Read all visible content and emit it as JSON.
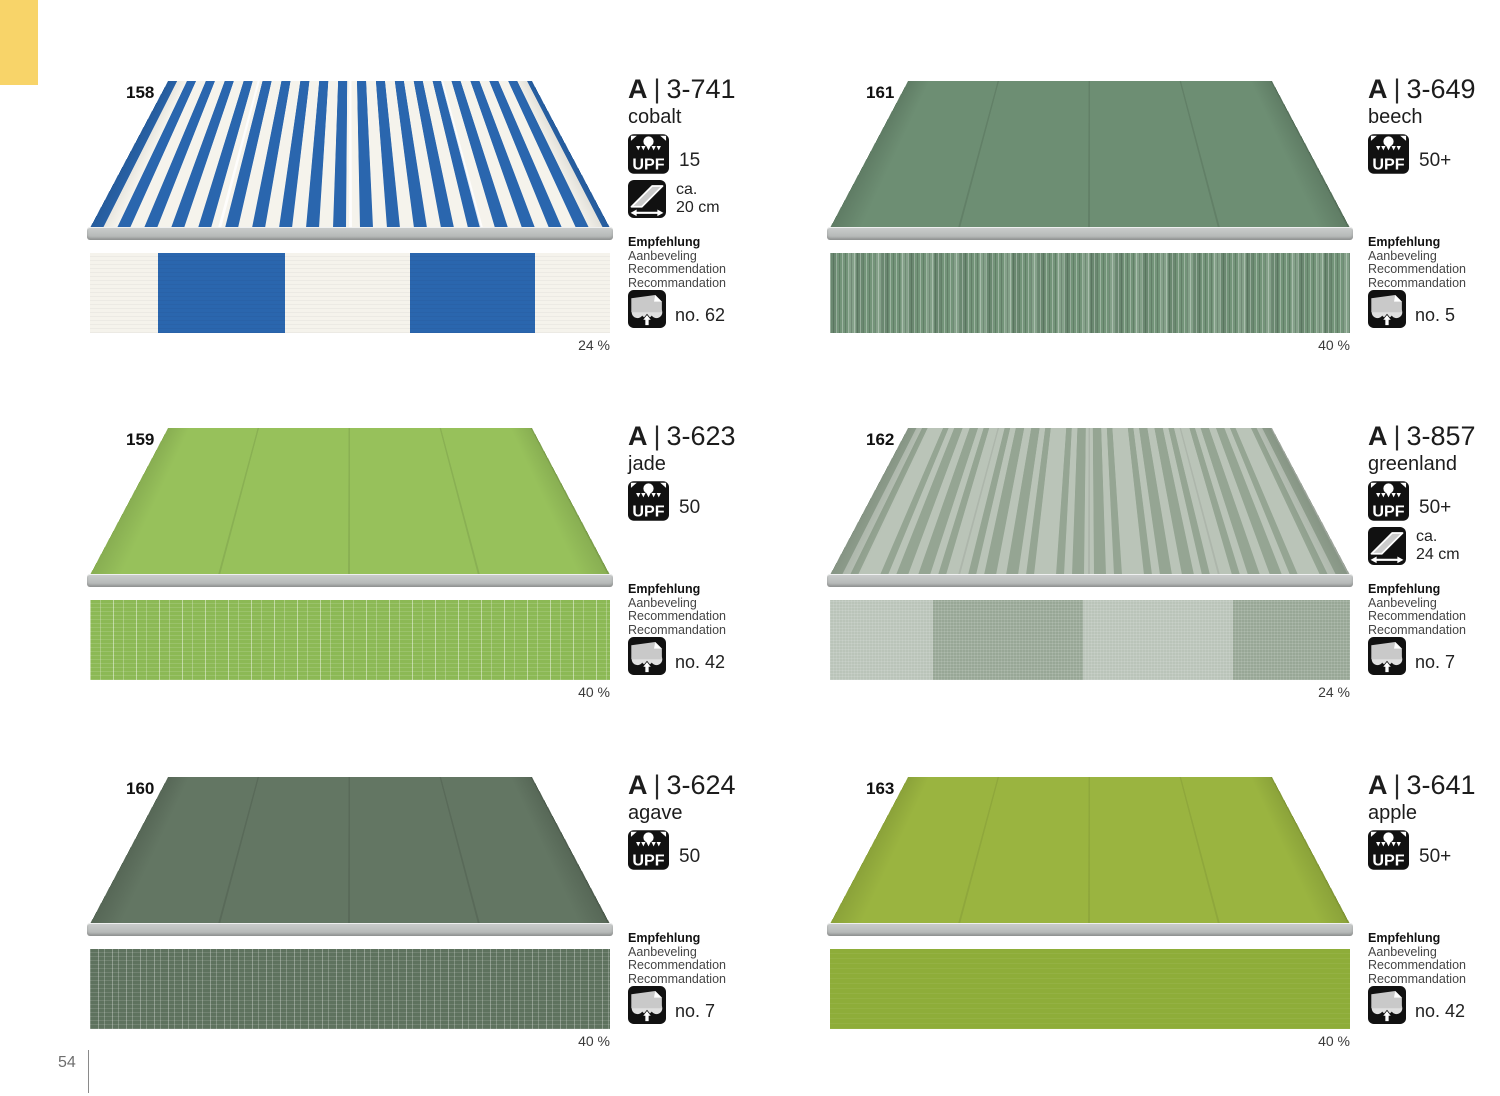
{
  "page": {
    "number": "54",
    "background": "#ffffff",
    "accent_color": "#f8d469"
  },
  "labels": {
    "code_prefix": "A",
    "code_separator": "|",
    "upf": "UPF",
    "approx": "ca.",
    "recommendation_lines": [
      "Empfehlung",
      "Aanbeveling",
      "Recommendation",
      "Recommandation"
    ]
  },
  "icons": {
    "upf": "upf-sun-icon",
    "width": "valance-width-icon",
    "recommendation": "awning-recommendation-icon"
  },
  "products": [
    {
      "number": "158",
      "code": "3-741",
      "name": "cobalt",
      "upf": "15",
      "width": "20 cm",
      "rec_no": "no. 62",
      "share": "24 %",
      "pattern": "block stripes",
      "colors": {
        "fabric": "#2a66ae",
        "base": "#f5f3ec"
      }
    },
    {
      "number": "161",
      "code": "3-649",
      "name": "beech",
      "upf": "50+",
      "rec_no": "no. 5",
      "share": "40 %",
      "pattern": "solid textured",
      "colors": {
        "fabric": "#6d8e73"
      }
    },
    {
      "number": "159",
      "code": "3-623",
      "name": "jade",
      "upf": "50",
      "rec_no": "no. 42",
      "share": "40 %",
      "pattern": "solid textured",
      "colors": {
        "fabric": "#97c15b"
      }
    },
    {
      "number": "162",
      "code": "3-857",
      "name": "greenland",
      "upf": "50+",
      "width": "24 cm",
      "rec_no": "no. 7",
      "share": "24 %",
      "pattern": "irregular stripes",
      "colors": {
        "fabric": "#95a593",
        "base": "#bac4b8"
      }
    },
    {
      "number": "160",
      "code": "3-624",
      "name": "agave",
      "upf": "50",
      "rec_no": "no. 7",
      "share": "40 %",
      "pattern": "solid textured",
      "colors": {
        "fabric": "#637663"
      }
    },
    {
      "number": "163",
      "code": "3-641",
      "name": "apple",
      "upf": "50+",
      "rec_no": "no. 42",
      "share": "40 %",
      "pattern": "solid",
      "colors": {
        "fabric": "#9ab440"
      }
    }
  ]
}
